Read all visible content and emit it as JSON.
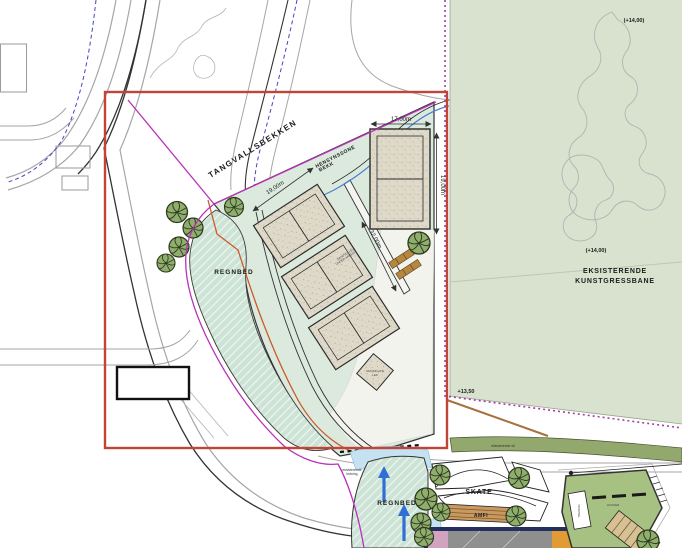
{
  "labels": {
    "tangvallsbekken": "TANGVALLSBEKKEN",
    "hensynssone_line1": "HENSYNSSONE",
    "hensynssone_line2": "BEKK",
    "regnbed_west": "REGNBED",
    "regnbed_south": "REGNBED",
    "skate": "SKATE",
    "amfi": "AMFI",
    "existing_pitch_line1": "EKSISTERENDE",
    "existing_pitch_line2": "KUNSTGRESSBANE",
    "court_note_line1": "SANDVOLLEY",
    "court_note_line2": "UNDER ARBEID",
    "gravel_note_line1": "GRUSFLATE",
    "gravel_note_line2": "LEK",
    "trening": "TRENING",
    "husker": "HUSKER",
    "pipe_note_line1": "eksisterende",
    "pipe_note_line2": "ledning",
    "path_note": "eksisterende sti"
  },
  "elevations": {
    "field_top": "(+14,00)",
    "field_mid": "(+14,00)",
    "corner": "+13,50"
  },
  "dimensions": {
    "court_width": "17,00m",
    "court_height": "19,00m",
    "diag_width": "19,00m",
    "diag_length": "32,00m"
  },
  "colors": {
    "site_green": "#dceade",
    "regnbed_green": "#cde3d6",
    "field_green": "#d8e2cf",
    "court_beige": "#ded9c9",
    "tree_green": "#8fae6d",
    "boundary_red": "#c04537",
    "boundary_magenta": "#b832b8",
    "field_purple": "#a23fa2",
    "stream_blue": "#4c7fd0",
    "arrow_blue": "#2f6fd6",
    "building_navy": "#23305e",
    "amfi_brown": "#c9995f",
    "play_green": "#a7c183"
  }
}
